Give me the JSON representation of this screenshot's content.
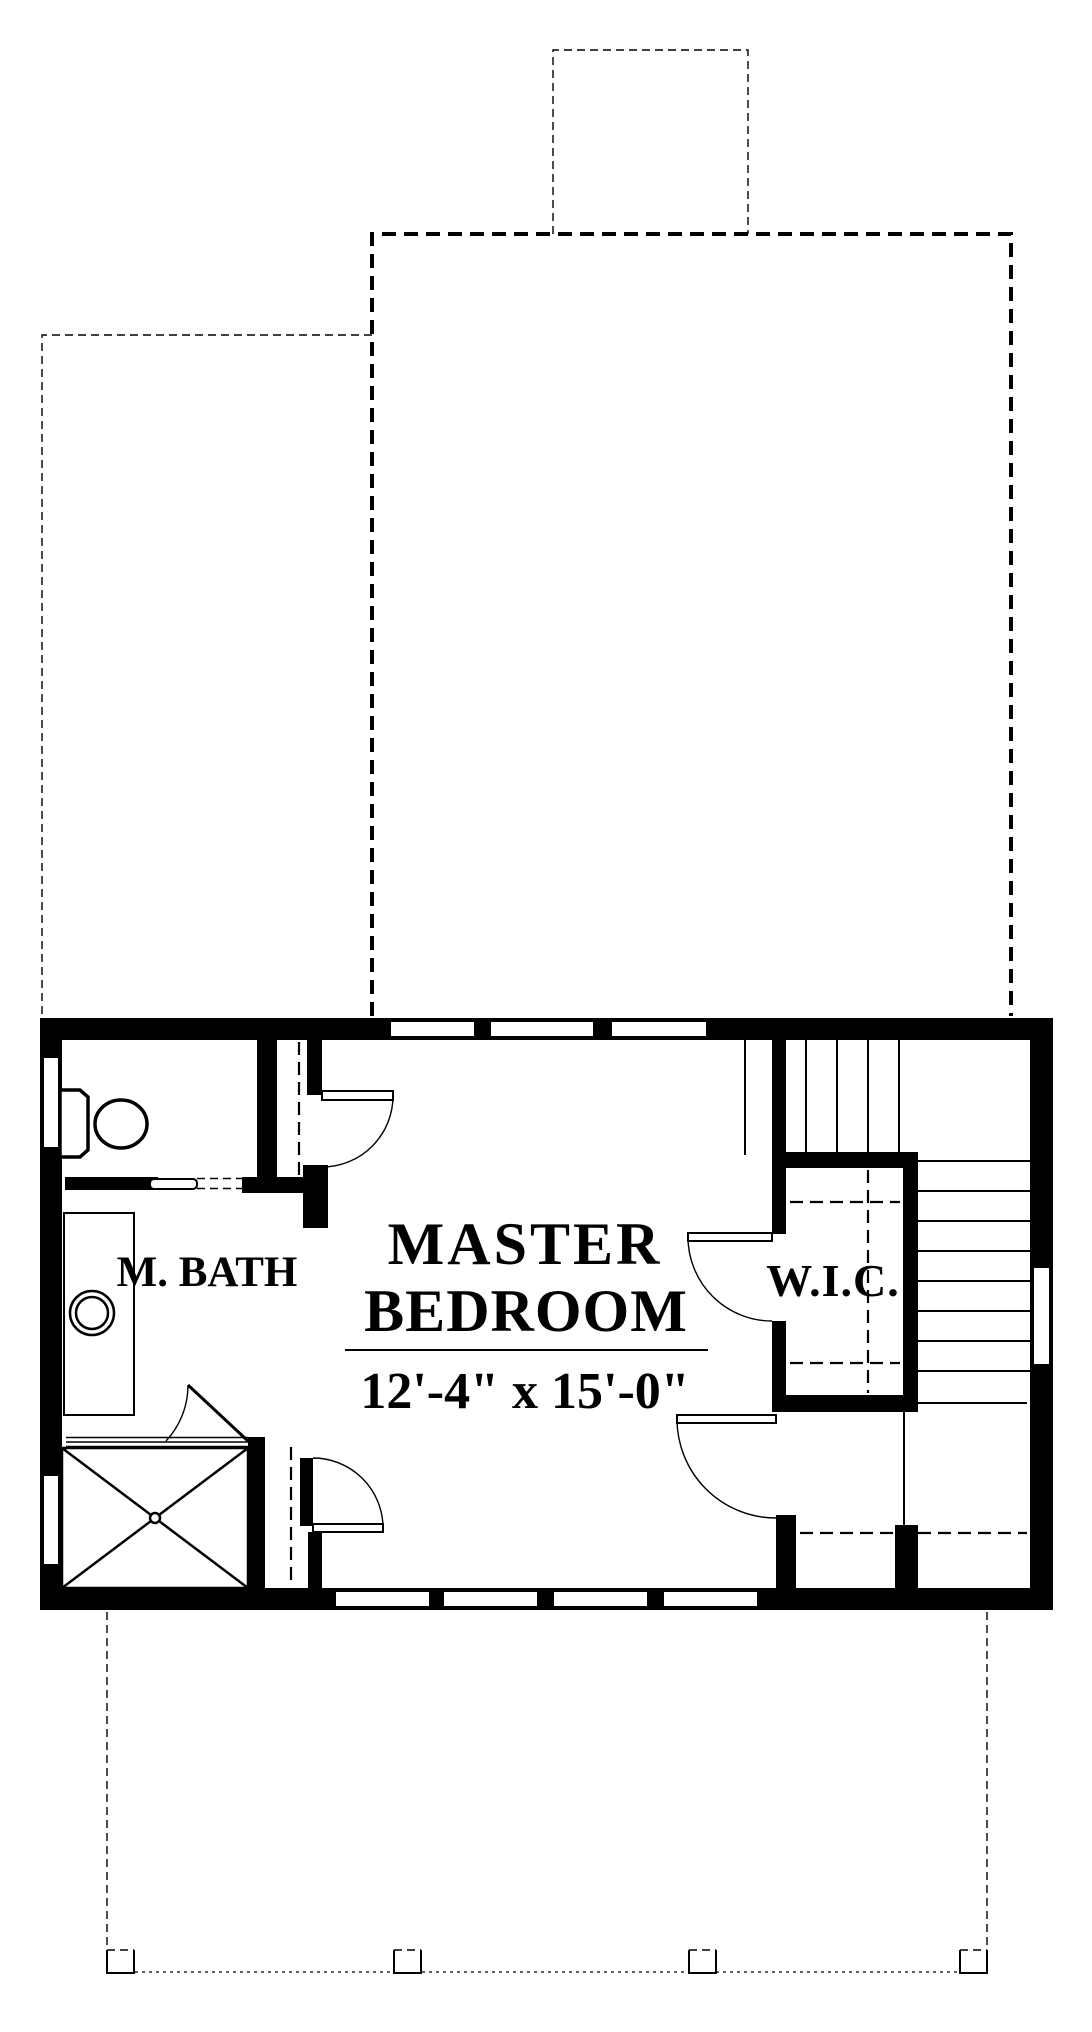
{
  "page": {
    "background_color": "#ffffff",
    "line_color": "#000000",
    "type": "architectural floor plan"
  },
  "labels": {
    "master_bedroom_line1": "MASTER",
    "master_bedroom_line2": "BEDROOM",
    "master_bedroom_dimensions": "12'-4\" x 15'-0\"",
    "master_bath": "M. BATH",
    "walk_in_closet": "W.I.C."
  },
  "fixtures": [
    {
      "name": "toilet-fixture",
      "room": "master bath"
    },
    {
      "name": "sink-fixture",
      "room": "master bath"
    },
    {
      "name": "vanity-counter",
      "room": "master bath"
    },
    {
      "name": "shower-pan",
      "room": "master bath"
    }
  ],
  "features": [
    {
      "name": "chimney-outline",
      "style": "thin dashed"
    },
    {
      "name": "roof-outline-upper",
      "style": "bold dashed"
    },
    {
      "name": "roof-outline-left",
      "style": "thin dashed"
    },
    {
      "name": "stair-upper-run",
      "treads": 4
    },
    {
      "name": "stair-lower-run",
      "treads": 9
    },
    {
      "name": "closet-shelving",
      "style": "dashed"
    },
    {
      "name": "porch-outline",
      "style": "dashed",
      "posts": 4
    },
    {
      "name": "windows",
      "count": 10
    },
    {
      "name": "door-swings",
      "count": 5
    }
  ]
}
